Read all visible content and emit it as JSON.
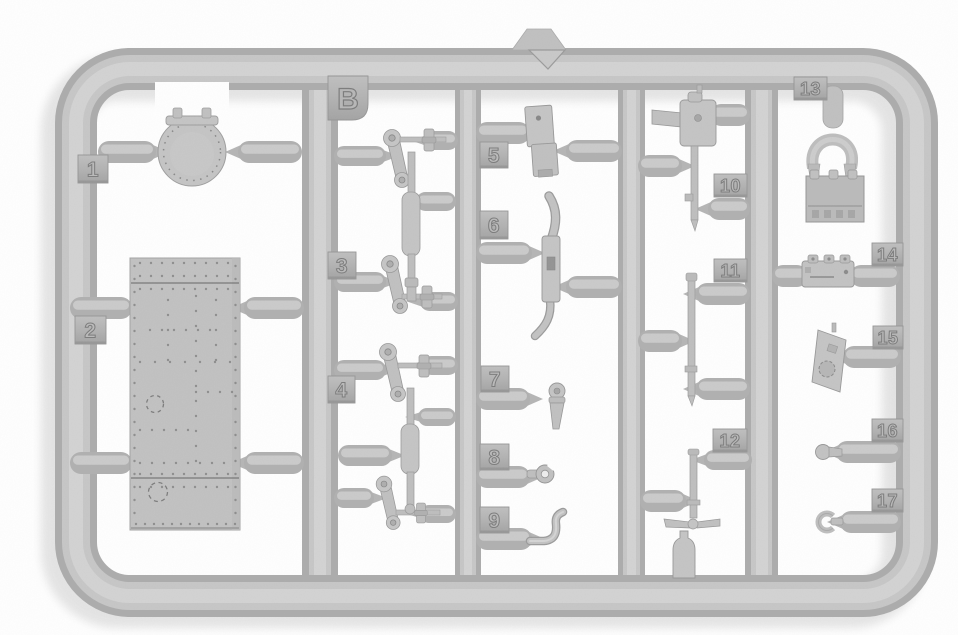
{
  "sheet": {
    "label": "B"
  },
  "part_tags": [
    {
      "number": "1"
    },
    {
      "number": "2"
    },
    {
      "number": "3"
    },
    {
      "number": "4"
    },
    {
      "number": "5"
    },
    {
      "number": "6"
    },
    {
      "number": "7"
    },
    {
      "number": "8"
    },
    {
      "number": "9"
    },
    {
      "number": "10"
    },
    {
      "number": "11"
    },
    {
      "number": "12"
    },
    {
      "number": "13"
    },
    {
      "number": "14"
    },
    {
      "number": "15"
    },
    {
      "number": "16"
    },
    {
      "number": "17"
    }
  ],
  "palette": {
    "background": "#ffffff",
    "plastic": "#c4c4c4",
    "plastic_highlight": "#d4d4d4",
    "plastic_shadow": "#9e9e9e",
    "tag_plate": "#b4b4b4",
    "engraved_line": "#7e7e7e",
    "drop_shadow": "#e3e3e3"
  }
}
